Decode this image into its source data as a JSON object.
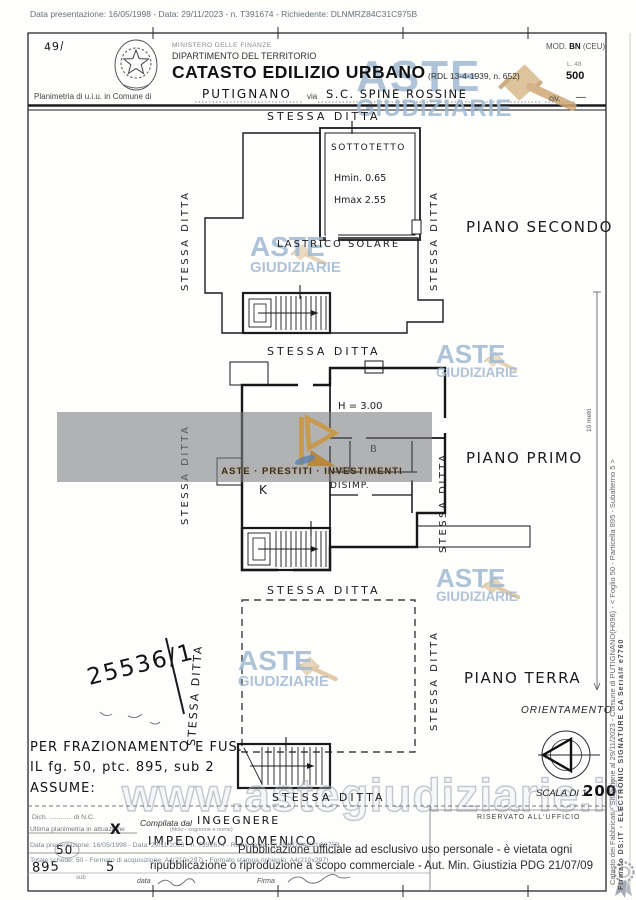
{
  "colors": {
    "watermark_blue": "#a0b9d0",
    "gavel_gold": "#d9ba8c",
    "banner_gray": "rgba(125,127,131,0.6)",
    "logo_gold": "#c79a4e",
    "ink": "#1d1d1f",
    "digital_gray": "#6b7a88"
  },
  "icons": {
    "gavel": "gavel-icon",
    "state_emblem": "italy-emblem-icon",
    "compass": "orientation-compass-icon",
    "rosette": "certification-rosette-icon"
  },
  "top_bar": {
    "text": "Data presentazione: 16/05/1998 - Data: 29/11/2023 - n. T391674 - Richiedente: DLNMRZ84C31C975B"
  },
  "header": {
    "corner_note": "49/",
    "ministry": "MINISTERO DELLE FINANZE",
    "department": "DIPARTIMENTO DEL TERRITORIO",
    "title": "CATASTO EDILIZIO URBANO",
    "title_ref": "(RDL 13-4-1939, n. 652)",
    "mod_label": "MOD.",
    "mod_value": "BN",
    "mod_note": "(CEU)",
    "stamp_small": "L. 48",
    "stamp_value": "500",
    "planimetria_label": "Planimetria di u.i.u. in Comune di",
    "comune": "PUTIGNANO",
    "via_label": "via",
    "via_value": "S.C. SPINE ROSSINE",
    "civ_label": "civ.",
    "civ_value": "—"
  },
  "labels": {
    "stessa_ditta": "STESSA DITTA"
  },
  "floors": {
    "secondo": {
      "name": "PIANO SECONDO",
      "sottotetto": "SOTTOTETTO",
      "hmin": "Hmin. 0.65",
      "hmax": "Hmax 2.55",
      "lastrico": "LASTRICO SOLARE"
    },
    "primo": {
      "name": "PIANO PRIMO",
      "height_note": "H = 3.00",
      "room_b": "B",
      "ingresso": "INGR.",
      "disimpegno": "DISIMP.",
      "room_k": "K"
    },
    "terra": {
      "name": "PIANO TERRA",
      "protocol_note": "25536/1"
    }
  },
  "orientation": {
    "title": "ORIENTAMENTO"
  },
  "scale": {
    "label": "SCALA DI 1:",
    "value": "200",
    "bar_label": "10 metri"
  },
  "annotations": {
    "line1": "PER FRAZIONAMENTO E FUS.",
    "line2": "IL fg. 50, ptc. 895, sub 2",
    "line3": "ASSUME:"
  },
  "form": {
    "nc_line": "Dich. ............ di N.C.",
    "planimetria_line": "Ultima planimetria in attuazione",
    "check_mark": "X",
    "compilata_label": "Compilata dal",
    "compilata_title": "INGEGNERE",
    "compilata_note": "(titolo - cognome e nome)",
    "compilata_name": "IMPEDOVO DOMENICO",
    "riservato": "RISERVATO ALL'UFFICIO",
    "foglio_value": "50",
    "particella_value": "895",
    "sub_label": "sub",
    "sub_value": "5",
    "data_label": "data",
    "firma_label": "Firma"
  },
  "footer": {
    "presentazione": "Data presentazione: 16/05/1998 - Data: 29/11/2023 - n. T391674 - Richiedente: DLNMRZ84C31C975B",
    "schede": "Totale schede: 50 - Formato di acquisizione: A4(210x297) - Formato stampa richiesto: A4(210x297)",
    "notice1": "Pubblicazione ufficiale ad esclusivo uso personale - è vietata ogni",
    "notice2": "ripubblicazione o riproduzione a scopo commerciale - Aut. Min. Giustizia PDG 21/07/09"
  },
  "right_margin": {
    "catasto_line": "Catasto dei Fabbricati - Situazione al 29/11/2023 - Comune di PUTIGNANO(H096) - < Foglio 50 - Particella 895 - Subalterno 5 >",
    "firma_line": "Firmato DS:IT - ELECTRONIC SIGNATURE CA Serial# e7760"
  },
  "watermarks": {
    "aste": "ASTE",
    "giudiziarie": "GIUDIZIARIE",
    "url": "www.astegiudiziarie.it",
    "banner": "ASTE · PRESTITI · INVESTIMENTI"
  }
}
